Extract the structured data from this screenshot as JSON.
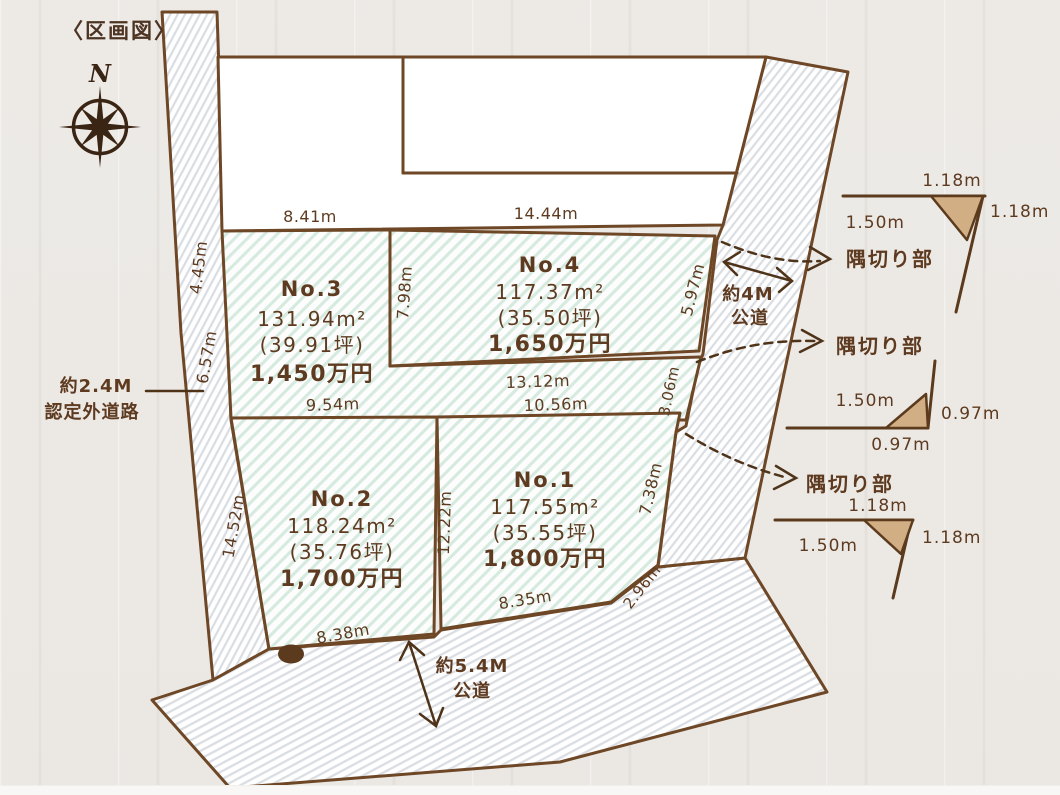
{
  "title": "〈区画図〉",
  "compass": {
    "label": "N"
  },
  "lots": [
    {
      "name": "No.1",
      "area": "117.55m²",
      "tsubo": "(35.55坪)",
      "price": "1,800万円"
    },
    {
      "name": "No.2",
      "area": "118.24m²",
      "tsubo": "(35.76坪)",
      "price": "1,700万円"
    },
    {
      "name": "No.3",
      "area": "131.94m²",
      "tsubo": "(39.91坪)",
      "price": "1,450万円"
    },
    {
      "name": "No.4",
      "area": "117.37m²",
      "tsubo": "(35.50坪)",
      "price": "1,650万円"
    }
  ],
  "dims": {
    "no3_top": "8.41m",
    "no4_top": "14.44m",
    "no3_left_upper": "4.45m",
    "no3_left_lower": "6.57m",
    "no3_no4_divider": "7.98m",
    "no4_right": "5.97m",
    "no4_bottom": "13.12m",
    "no3_bottom": "9.54m",
    "no1_top": "10.56m",
    "strip_right": "3.06m",
    "no2_left": "14.52m",
    "no1_no2_divider": "12.22m",
    "no1_right": "7.38m",
    "no1_bottom": "8.35m",
    "no1_corner": "2.96m",
    "no2_bottom": "8.38m"
  },
  "roads": {
    "left_line1": "約2.4M",
    "left_line2": "認定外道路",
    "right_line1": "約4M",
    "right_line2": "公道",
    "bottom_line1": "約5.4M",
    "bottom_line2": "公道"
  },
  "corner_cut_label": "隅切り部",
  "corner_details": [
    {
      "top": "1.18m",
      "left": "1.50m",
      "right": "1.18m"
    },
    {
      "upper": "1.50m",
      "right": "0.97m",
      "bottom": "0.97m"
    },
    {
      "top": "1.18m",
      "left": "1.50m",
      "right": "1.18m"
    }
  ],
  "colors": {
    "line": "#6e4726",
    "text": "#5e3b20",
    "lot_stripe": "#d6eadf",
    "road_stripe": "#d9dde3",
    "corner_fill": "#d2ae85",
    "background": "#ece9e5"
  }
}
